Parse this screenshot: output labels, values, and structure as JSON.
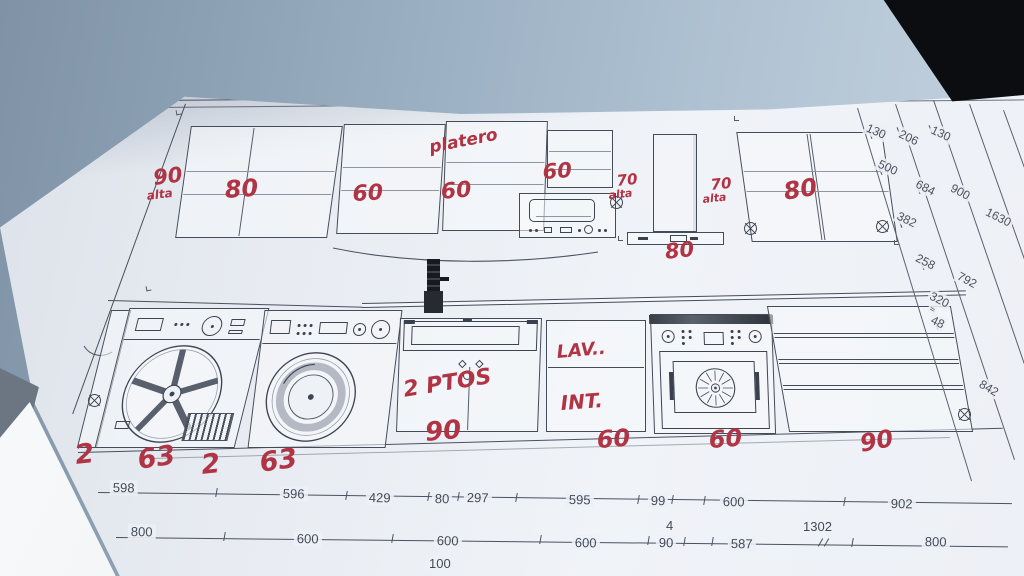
{
  "colors": {
    "paper": "#edf0f6",
    "surface_blue": "#9db1c3",
    "plan_line": "#454c59",
    "red_ink": "#b03444",
    "dark_corner": "#0b0d10"
  },
  "red_notes": {
    "left_height_value": "90",
    "left_height_word": "alta",
    "cab1_width": "80",
    "cab2_width": "60",
    "platero_label": "platero",
    "cab3_width": "60",
    "cab4_width": "60",
    "hood_left_value": "70",
    "hood_left_word": "alta",
    "hood_right_value": "70",
    "hood_right_word": "alta",
    "right_cab_width": "80",
    "hood_width": "80",
    "sink_doors": "2 PTOS",
    "sink_width": "90",
    "dw_line1": "LAV..",
    "dw_line2": "INT.",
    "dw_width": "60",
    "oven_width": "60",
    "drawers_width": "90",
    "gap1": "2",
    "gap2": "63",
    "gap3": "2",
    "gap4": "63"
  },
  "dimensions": {
    "cascade": [
      "130",
      "206",
      "130",
      "500",
      "684",
      "900",
      "382",
      "1630",
      "258",
      "792",
      "320",
      "48",
      "842"
    ],
    "row1": [
      "598",
      "596",
      "429",
      "80",
      "297",
      "595",
      "99",
      "600",
      "902"
    ],
    "row2": [
      "800",
      "600",
      "600",
      "600",
      "90",
      "587",
      "800"
    ],
    "row2_above": [
      "4",
      "1302"
    ],
    "row3": [
      "100"
    ],
    "break_mark": "≈"
  }
}
